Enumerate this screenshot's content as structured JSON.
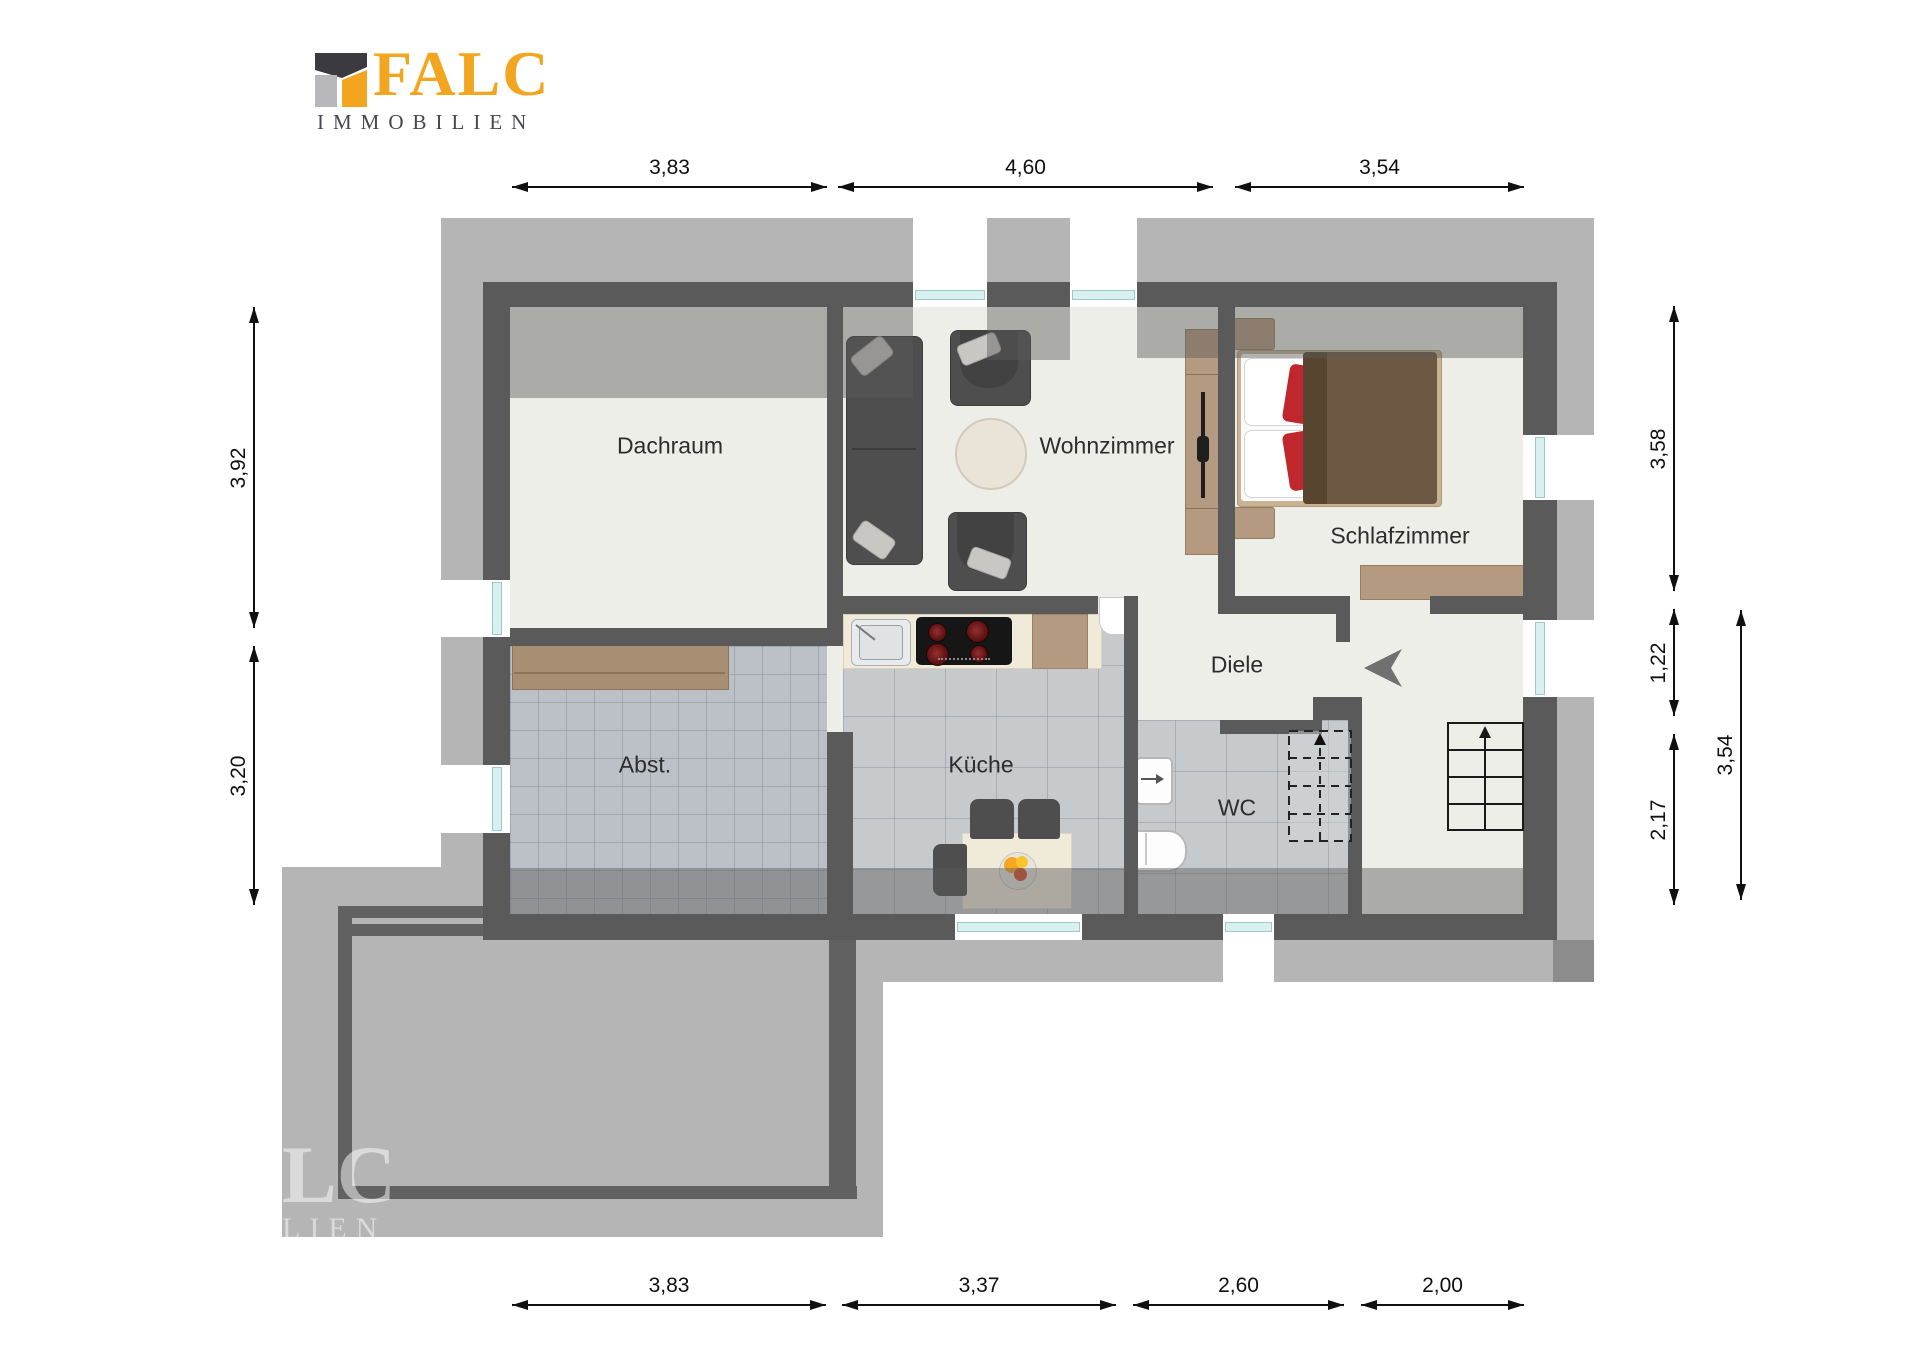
{
  "logo": {
    "brand": "FALC",
    "subtitle": "IMMOBILIEN",
    "brand_color": "#f2a51f",
    "subtitle_color": "#474750",
    "mark_colors": {
      "roof": "#3a3a40",
      "left_block": "#b8b8bc",
      "right_block": "#f2a51f"
    }
  },
  "watermark": {
    "line1": "LC",
    "line2": "LIEN"
  },
  "rooms": {
    "dachraum": {
      "label": "Dachraum"
    },
    "wohnzimmer": {
      "label": "Wohnzimmer"
    },
    "schlafzimmer": {
      "label": "Schlafzimmer"
    },
    "abstellraum": {
      "label": "Abst."
    },
    "kueche": {
      "label": "Küche"
    },
    "diele": {
      "label": "Diele"
    },
    "wc": {
      "label": "WC"
    }
  },
  "dimensions": {
    "top": [
      {
        "label": "3,83"
      },
      {
        "label": "4,60"
      },
      {
        "label": "3,54"
      }
    ],
    "bottom": [
      {
        "label": "3,83"
      },
      {
        "label": "3,37"
      },
      {
        "label": "2,60"
      },
      {
        "label": "2,00"
      }
    ],
    "left": [
      {
        "label": "3,92"
      },
      {
        "label": "3,20"
      }
    ],
    "right_inner": [
      {
        "label": "3,58"
      },
      {
        "label": "1,22"
      },
      {
        "label": "2,17"
      }
    ],
    "right_outer": [
      {
        "label": "3,54"
      }
    ]
  },
  "colors": {
    "floor": "#edeee8",
    "wall": "#5a5a5a",
    "roof_shadow": "rgba(90,90,90,0.45)",
    "tile_storage": "#bcc1c7",
    "tile_kitchen": "#c6cacd",
    "window_glass": "#d8f0f0",
    "wood_furniture": "#b49a80",
    "sofa": "#4e4e4e",
    "bed_duvet": "#6d5844",
    "accent_red": "#c0272d",
    "dimension_text": "#101010"
  }
}
